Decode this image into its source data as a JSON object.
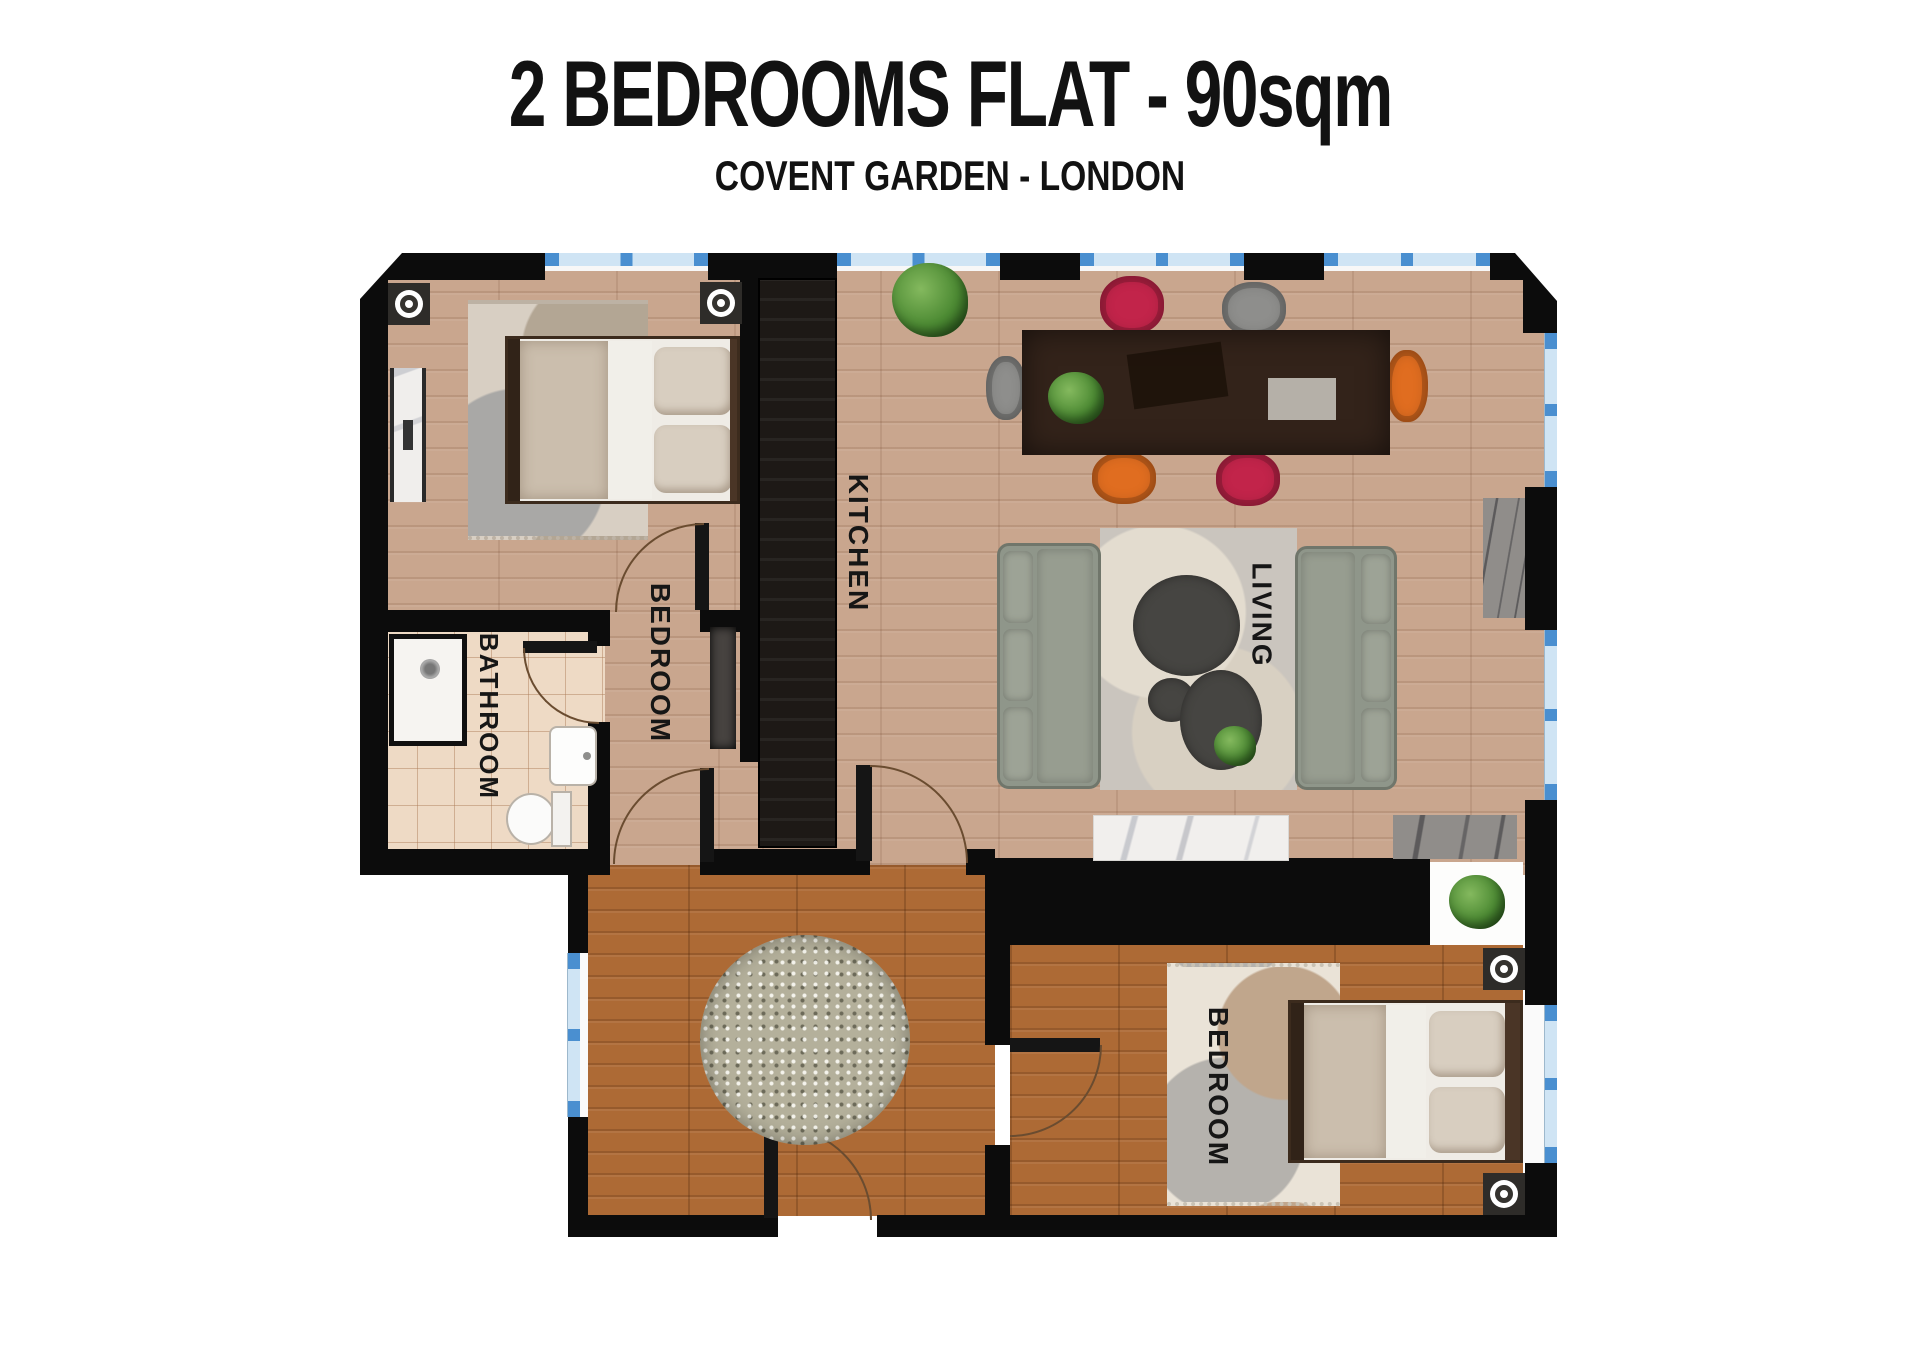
{
  "header": {
    "title": "2 BEDROOMS FLAT - 90sqm",
    "subtitle": "COVENT GARDEN - LONDON"
  },
  "rooms": {
    "bedroom_top": {
      "label": "BEDROOM"
    },
    "bathroom": {
      "label": "BATHROOM"
    },
    "kitchen": {
      "label": "KITCHEN"
    },
    "living": {
      "label": "LIVING"
    },
    "bedroom_bottom": {
      "label": "BEDROOM"
    }
  },
  "palette": {
    "wall": "#0c0c0c",
    "floor_light": "#c9a68e",
    "floor_dark": "#ad6a35",
    "bathroom_tile": "#eedac5",
    "window_blue": "#cfe4f4",
    "window_accent": "#4a8fd0",
    "counter": "#1d1916",
    "table": "#33231a",
    "chair_red": "#c2244a",
    "chair_orange": "#e06d20",
    "chair_gray": "#8e8e8c",
    "sofa": "#939a8d",
    "door_arc": "#6a4c30",
    "label_text": "#161616"
  }
}
